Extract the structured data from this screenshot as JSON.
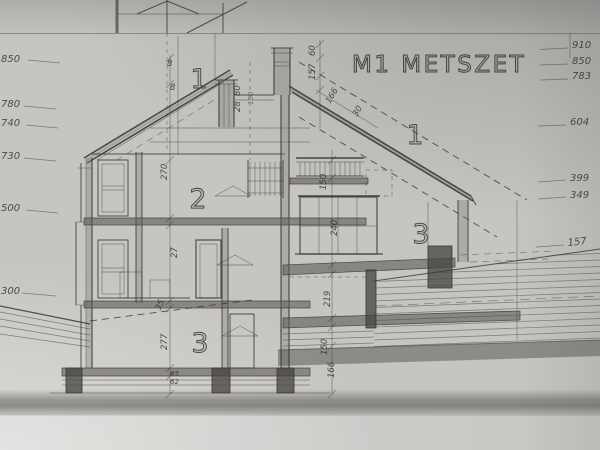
{
  "drawing": {
    "title": "M1 METSZET",
    "room_labels": [
      {
        "text": "1"
      },
      {
        "text": "2"
      },
      {
        "text": "3"
      },
      {
        "text": "1"
      },
      {
        "text": "3"
      }
    ],
    "left_elevations": [
      {
        "label": "850"
      },
      {
        "label": "780"
      },
      {
        "label": "740"
      },
      {
        "label": "730"
      },
      {
        "label": "500"
      },
      {
        "label": "300"
      }
    ],
    "right_elevations": [
      {
        "label": "910"
      },
      {
        "label": "850"
      },
      {
        "label": "783"
      },
      {
        "label": "604"
      },
      {
        "label": "399"
      },
      {
        "label": "349"
      },
      {
        "label": "157"
      }
    ],
    "dimensions": [
      {
        "text": "8"
      },
      {
        "text": "8"
      },
      {
        "text": "80"
      },
      {
        "text": "28"
      },
      {
        "text": "150"
      },
      {
        "text": "60"
      },
      {
        "text": "157"
      },
      {
        "text": "166"
      },
      {
        "text": "30"
      },
      {
        "text": "270"
      },
      {
        "text": "27"
      },
      {
        "text": "277"
      },
      {
        "text": "65"
      },
      {
        "text": "62"
      },
      {
        "text": "35"
      },
      {
        "text": "150"
      },
      {
        "text": "240"
      },
      {
        "text": "219"
      },
      {
        "text": "150"
      },
      {
        "text": "166"
      }
    ],
    "colors": {
      "paper": "#c6c5c2",
      "ink": "#3b3936"
    }
  }
}
